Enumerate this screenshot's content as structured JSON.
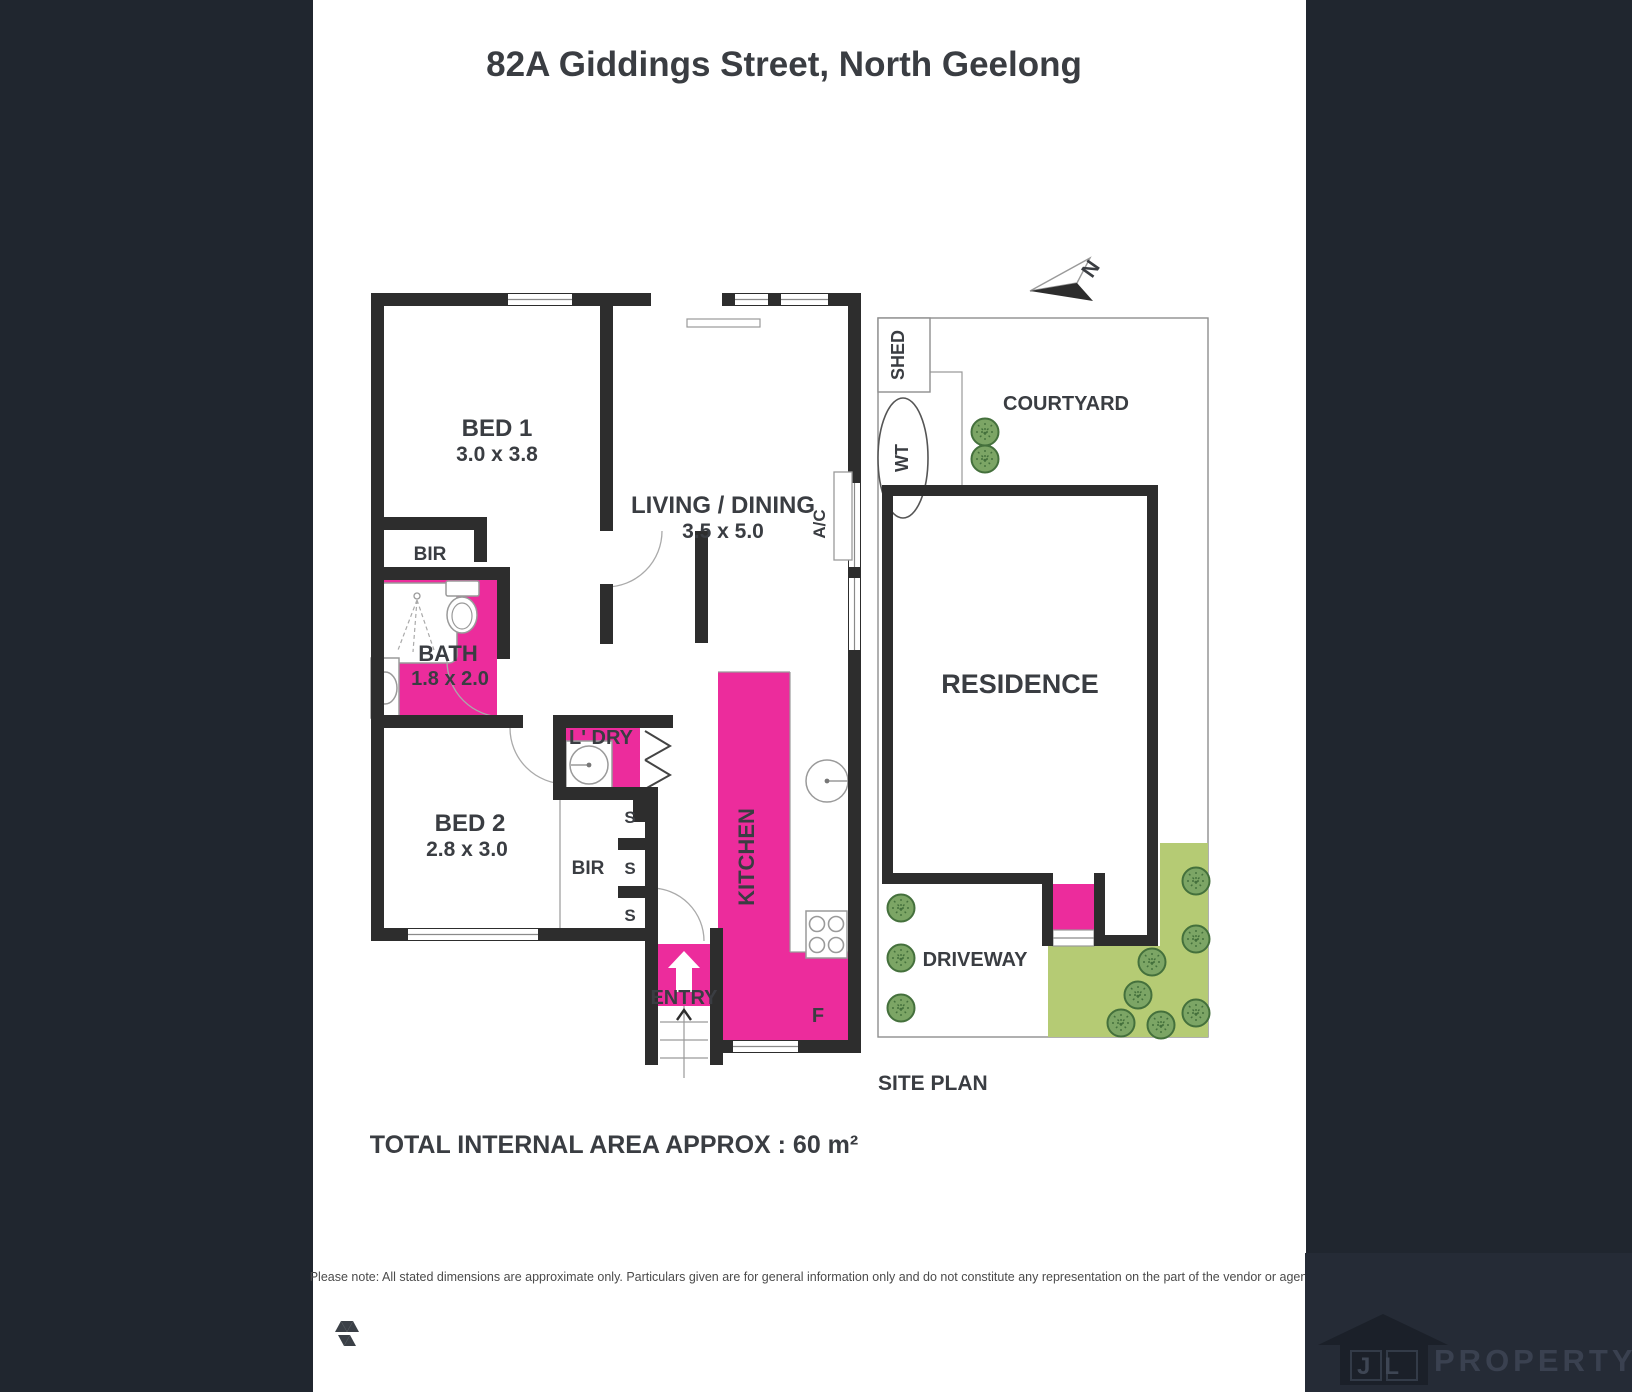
{
  "title": "82A Giddings Street, North Geelong",
  "colors": {
    "accent_pink": "#EC2C9C",
    "wall_black": "#2D2D2D",
    "side_band": "#20262F",
    "garden_green": "#B5CB74",
    "tree_green": "#7CA565",
    "label_text": "#3A3D42"
  },
  "floor_plan": {
    "rooms": {
      "bed1": {
        "name": "BED 1",
        "dims": "3.0 x 3.8"
      },
      "living": {
        "name": "LIVING / DINING",
        "dims": "3.5 x 5.0"
      },
      "bath": {
        "name": "BATH",
        "dims": "1.8 x 2.0"
      },
      "bed2": {
        "name": "BED 2",
        "dims": "2.8 x 3.0"
      },
      "laundry": {
        "name": "L' DRY"
      },
      "kitchen": {
        "name": "KITCHEN"
      },
      "entry": {
        "name": "ENTRY"
      }
    },
    "labels": {
      "bir1": "BIR",
      "bir2": "BIR",
      "s1": "S",
      "s2": "S",
      "s3": "S",
      "ac": "A/C",
      "fridge": "F"
    },
    "total_area": "TOTAL INTERNAL AREA APPROX : 60 m²"
  },
  "site_plan": {
    "title": "SITE PLAN",
    "labels": {
      "shed": "SHED",
      "water_tank": "WT",
      "courtyard": "COURTYARD",
      "residence": "RESIDENCE",
      "driveway": "DRIVEWAY"
    },
    "north": "N"
  },
  "footer": {
    "note": "Please note: All stated dimensions are approximate only. Particulars given are for general information only and do not constitute any representation on the part of the vendor or agent.",
    "brand": {
      "initials": "JL",
      "name": "PROPERTY"
    }
  }
}
